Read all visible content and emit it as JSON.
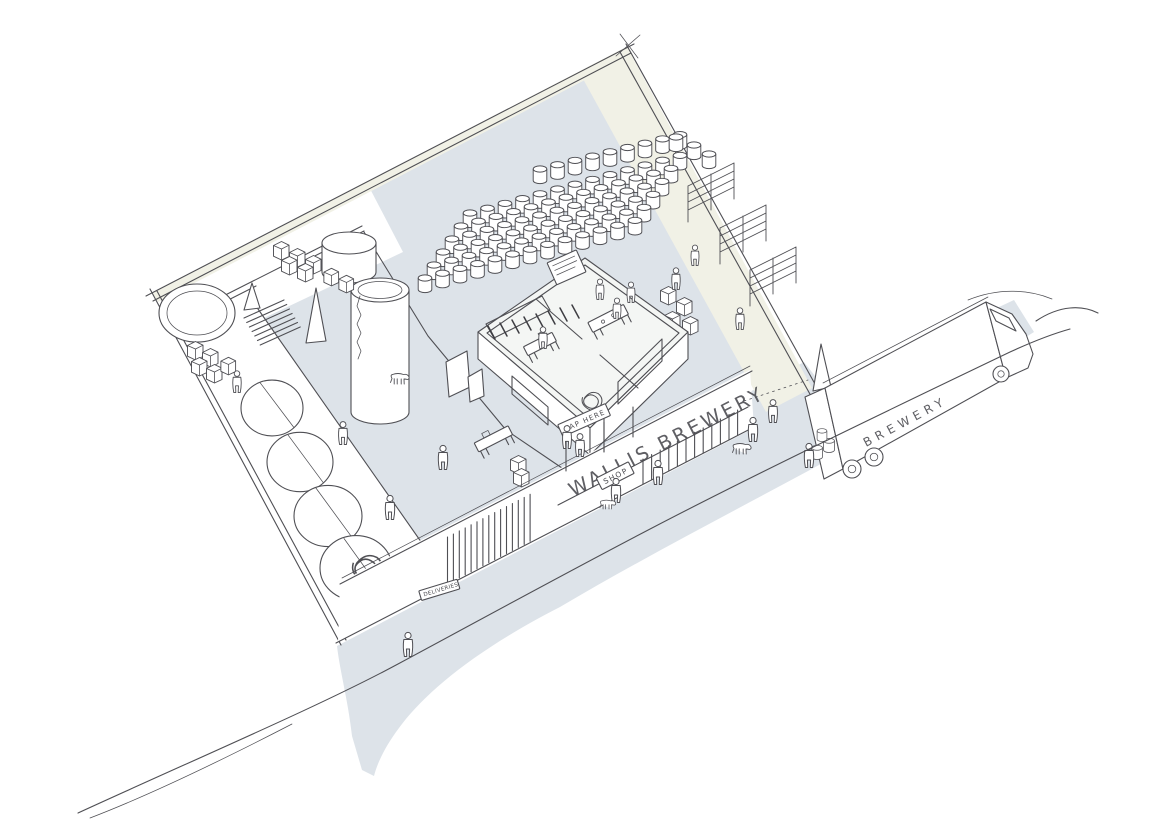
{
  "labels": {
    "facade_sign": "WALLIS BREWERY",
    "shop_sign": "SHOP",
    "tap_sign": "TAP HERE",
    "deliveries_sign": "DELIVERIES",
    "truck_sign": "BREWERY"
  },
  "colors": {
    "paper": "#ffffff",
    "floor": "#dde3e9",
    "wall_face": "#f1f1e6",
    "room_floor": "#f4f6f4",
    "line": "#4f4f54"
  },
  "scene": {
    "people": [
      [
        237,
        393,
        0.9
      ],
      [
        343,
        445,
        0.95
      ],
      [
        390,
        520,
        1
      ],
      [
        443,
        470,
        1
      ],
      [
        543,
        349,
        0.9
      ],
      [
        600,
        300,
        0.85
      ],
      [
        617,
        319,
        0.85
      ],
      [
        631,
        303,
        0.85
      ],
      [
        695,
        266,
        0.85
      ],
      [
        676,
        290,
        0.9
      ],
      [
        740,
        330,
        0.9
      ],
      [
        567,
        449,
        0.95
      ],
      [
        580,
        457,
        0.95
      ],
      [
        616,
        503,
        1
      ],
      [
        658,
        485,
        1
      ],
      [
        773,
        423,
        0.95
      ],
      [
        753,
        442,
        1
      ],
      [
        809,
        468,
        1
      ],
      [
        408,
        657,
        1
      ]
    ],
    "dogs": [
      [
        400,
        384,
        1
      ],
      [
        742,
        454,
        1
      ],
      [
        608,
        509,
        0.85
      ]
    ],
    "crates": [
      [
        281,
        258,
        1
      ],
      [
        297,
        265,
        1
      ],
      [
        313,
        272,
        1
      ],
      [
        289,
        273,
        1
      ],
      [
        305,
        280,
        1
      ],
      [
        331,
        284,
        0.95
      ],
      [
        346,
        291,
        0.95
      ],
      [
        195,
        358,
        1
      ],
      [
        210,
        365,
        1
      ],
      [
        199,
        374,
        1
      ],
      [
        214,
        381,
        1
      ],
      [
        228,
        373,
        0.95
      ],
      [
        518,
        472,
        1
      ],
      [
        521,
        485,
        1
      ],
      [
        668,
        303,
        1
      ],
      [
        684,
        314,
        1
      ],
      [
        672,
        328,
        1
      ],
      [
        690,
        333,
        1
      ]
    ],
    "racks": [
      [
        688,
        216
      ],
      [
        720,
        258
      ],
      [
        750,
        300
      ]
    ],
    "open_tanks": [
      {
        "cx": 272,
        "cy": 408,
        "r": 31
      },
      {
        "cx": 300,
        "cy": 462,
        "r": 33
      },
      {
        "cx": 328,
        "cy": 516,
        "r": 34
      },
      {
        "cx": 356,
        "cy": 568,
        "r": 36,
        "scribble": 1.8
      }
    ],
    "keg_rows": [
      {
        "x": 540,
        "y": 183,
        "n": 9,
        "dx": 17.5,
        "dy": -4.3,
        "rows": 1,
        "rowdx": 0,
        "rowdy": 0
      },
      {
        "x": 470,
        "y": 227,
        "n": 13,
        "dx": 17.5,
        "dy": -4.8,
        "rows": 6,
        "rowdx": -9,
        "rowdy": 13
      }
    ],
    "keg_extras": [
      [
        676,
        151
      ],
      [
        694,
        159
      ],
      [
        709,
        168
      ]
    ],
    "truck_kegs": [
      [
        817,
        459,
        0.8
      ],
      [
        829,
        452,
        0.8
      ],
      [
        822,
        441,
        0.72
      ]
    ],
    "stroke_series": [
      {
        "name": "shutter-corrugation",
        "x": 447.5,
        "y": 584,
        "n": 15,
        "dx": 5.9,
        "dy": -3.05,
        "lx": 0,
        "ly": -47
      },
      {
        "name": "shopfront-mullions",
        "x": 643,
        "y": 484,
        "n": 12,
        "dx": 8.6,
        "dy": -4.45,
        "lx": 0,
        "ly": -25
      },
      {
        "name": "stair-steps",
        "x": 244,
        "y": 318,
        "n": 7,
        "dx": 2.7,
        "dy": 4.5,
        "lx": 40,
        "ly": -18
      },
      {
        "name": "tap-door-edges",
        "x": 566,
        "y": 471,
        "n": 2,
        "dx": 38,
        "dy": -19,
        "lx": 0,
        "ly": -38
      },
      {
        "name": "shop-door-edges",
        "x": 604,
        "y": 452,
        "n": 2,
        "dx": 29,
        "dy": -15,
        "lx": 0,
        "ly": -30
      }
    ]
  }
}
